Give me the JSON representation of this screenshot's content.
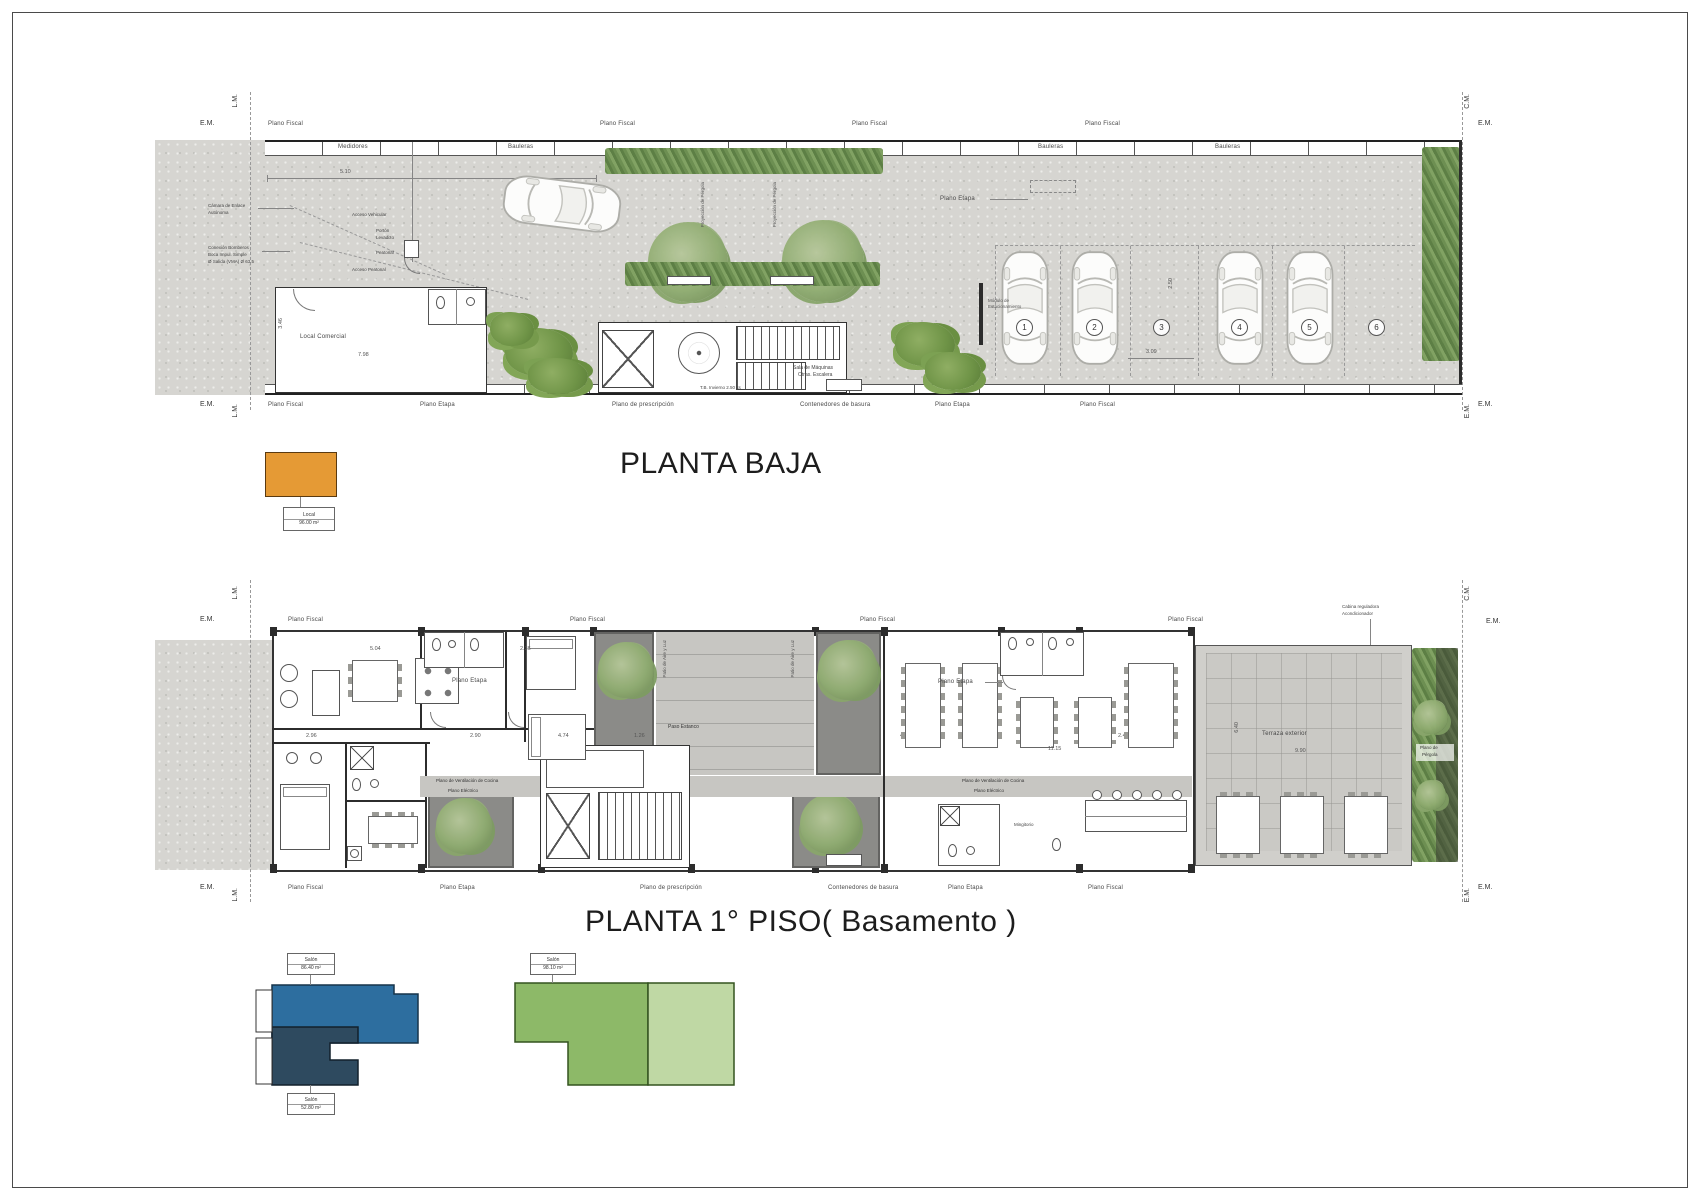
{
  "sheet": {
    "title_baja": "PLANTA BAJA",
    "title_piso1": "PLANTA 1° PISO( Basamento )"
  },
  "marks": {
    "em": "E.M.",
    "lm": "L.M.",
    "cm": "C.M."
  },
  "t": {
    "plano_fiscal": "Plano Fiscal",
    "plano_etapa": "Plano Etapa",
    "plano_prescripcion": "Plano de prescripción",
    "contenedores": "Contenedores de basura",
    "medidores": "Medidores",
    "bauleras": "Bauleras",
    "camara_l1": "Cámara de Enlace",
    "camara_l2": "Autónoma",
    "conexion_l1": "Conexión Bomberos",
    "conexion_l2": "Boca Impul. Simple",
    "conexion_l3": "Ø Salida (VMA) Ø 63.5",
    "acceso_vehicular": "Acceso Vehicular",
    "porton_l1": "Portón",
    "porton_l2": "Levadizo",
    "peatonal": "Peatonal",
    "acceso_peatonal": "Acceso Peatonal",
    "local_comercial": "Local Comercial",
    "sala_l1": "Sala de Máquinas",
    "sala_l2": "Otras. Escalera",
    "tb_escalera": "T.B. Invierno 2.50 lts",
    "proyeccion_pergola": "Proyección de Pérgola",
    "modulo_l1": "Módulo de",
    "modulo_l2": "Estacionamiento",
    "patio_aire": "Patio de Aire y Luz",
    "paso_estanco": "Paso Estanco",
    "vent_cocina": "Plano de Ventilación de Cocina",
    "plano_electrico": "Plano Eléctrico",
    "mingitorio": "Mingitorio",
    "terraza": "Terraza exterior",
    "cabina_l1": "Cabina reguladora",
    "cabina_l2": "Acondicionador",
    "pergola_l1": "Plano de",
    "pergola_l2": "Pérgola"
  },
  "dims": {
    "d510": "5.10",
    "d798": "7.98",
    "d346": "3.46",
    "d309": "3.09",
    "d250": "2.50",
    "d504": "5.04",
    "d236": "2.36",
    "d296": "2.96",
    "d290": "2.90",
    "d474": "4.74",
    "d126": "1.26",
    "d470": "4.70",
    "d246": "2.46",
    "d1115": "11.15",
    "d990": "9.90",
    "d640": "6.40"
  },
  "parking": {
    "spots": [
      "1",
      "2",
      "3",
      "4",
      "5",
      "6"
    ]
  },
  "legend": {
    "orange": {
      "l1": "Local",
      "l2": "96.00 m²"
    },
    "blue_top": {
      "l1": "Salón",
      "l2": "86.40 m²"
    },
    "blue_bottom": {
      "l1": "Salón",
      "l2": "52.80 m²"
    },
    "green": {
      "l1": "Salón",
      "l2": "98.10 m²"
    }
  },
  "colors": {
    "orange": "#E59A35",
    "blue": "#2D6E9F",
    "navy": "#2E4A5F",
    "green-dark": "#8DB968",
    "green-light": "#BFD8A4",
    "concrete": "#D6D5D1",
    "patio": "#8B8B88",
    "ink": "#222222"
  }
}
